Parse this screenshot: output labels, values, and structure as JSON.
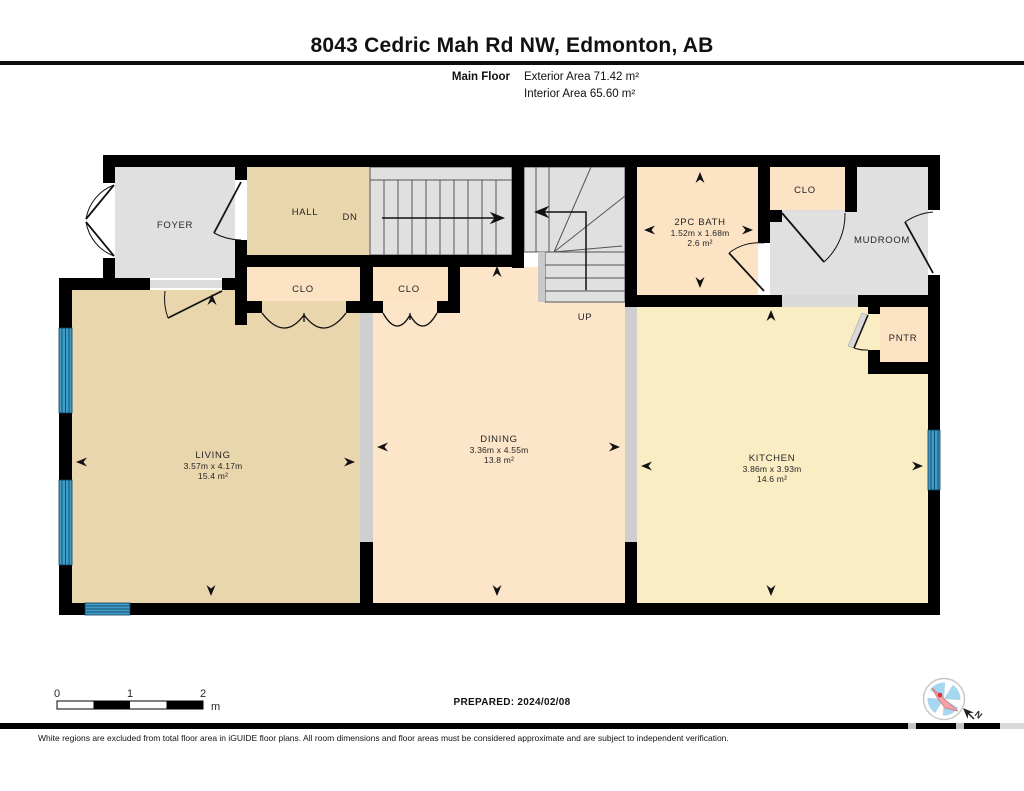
{
  "header": {
    "title": "8043 Cedric Mah Rd NW, Edmonton, AB",
    "floor_label": "Main Floor",
    "exterior_area": "Exterior Area 71.42 m²",
    "interior_area": "Interior Area 65.60 m²"
  },
  "rooms": {
    "foyer": {
      "name": "FOYER"
    },
    "hall": {
      "name": "HALL"
    },
    "stair_down": {
      "label": "DN"
    },
    "stair_up": {
      "label": "UP"
    },
    "closet_hall": {
      "name": "CLO"
    },
    "closet_dining": {
      "name": "CLO"
    },
    "closet_mudroom": {
      "name": "CLO"
    },
    "bath": {
      "name": "2PC BATH",
      "dims": "1.52m x 1.68m",
      "area": "2.6 m²"
    },
    "mudroom": {
      "name": "MUDROOM"
    },
    "pantry": {
      "name": "PNTR"
    },
    "living": {
      "name": "LIVING",
      "dims": "3.57m x 4.17m",
      "area": "15.4 m²"
    },
    "dining": {
      "name": "DINING",
      "dims": "3.36m x 4.55m",
      "area": "13.8 m²"
    },
    "kitchen": {
      "name": "KITCHEN",
      "dims": "3.86m x 3.93m",
      "area": "14.6 m²"
    }
  },
  "scale_bar": {
    "ticks": [
      "0",
      "1",
      "2"
    ],
    "unit": "m"
  },
  "compass": {
    "north_label": "N"
  },
  "footer": {
    "prepared": "PREPARED: 2024/02/08",
    "disclaimer": "White regions are excluded from total floor area in iGUIDE floor plans. All room dimensions and floor areas must be considered approximate and are subject to independent verification."
  },
  "colors": {
    "wall": "#000000",
    "room_tan": "#e9d6ac",
    "room_peach": "#fbe3c4",
    "room_cream": "#faecc3",
    "room_gray": "#e0e0e0",
    "window_blue": "#3f9dc9"
  }
}
